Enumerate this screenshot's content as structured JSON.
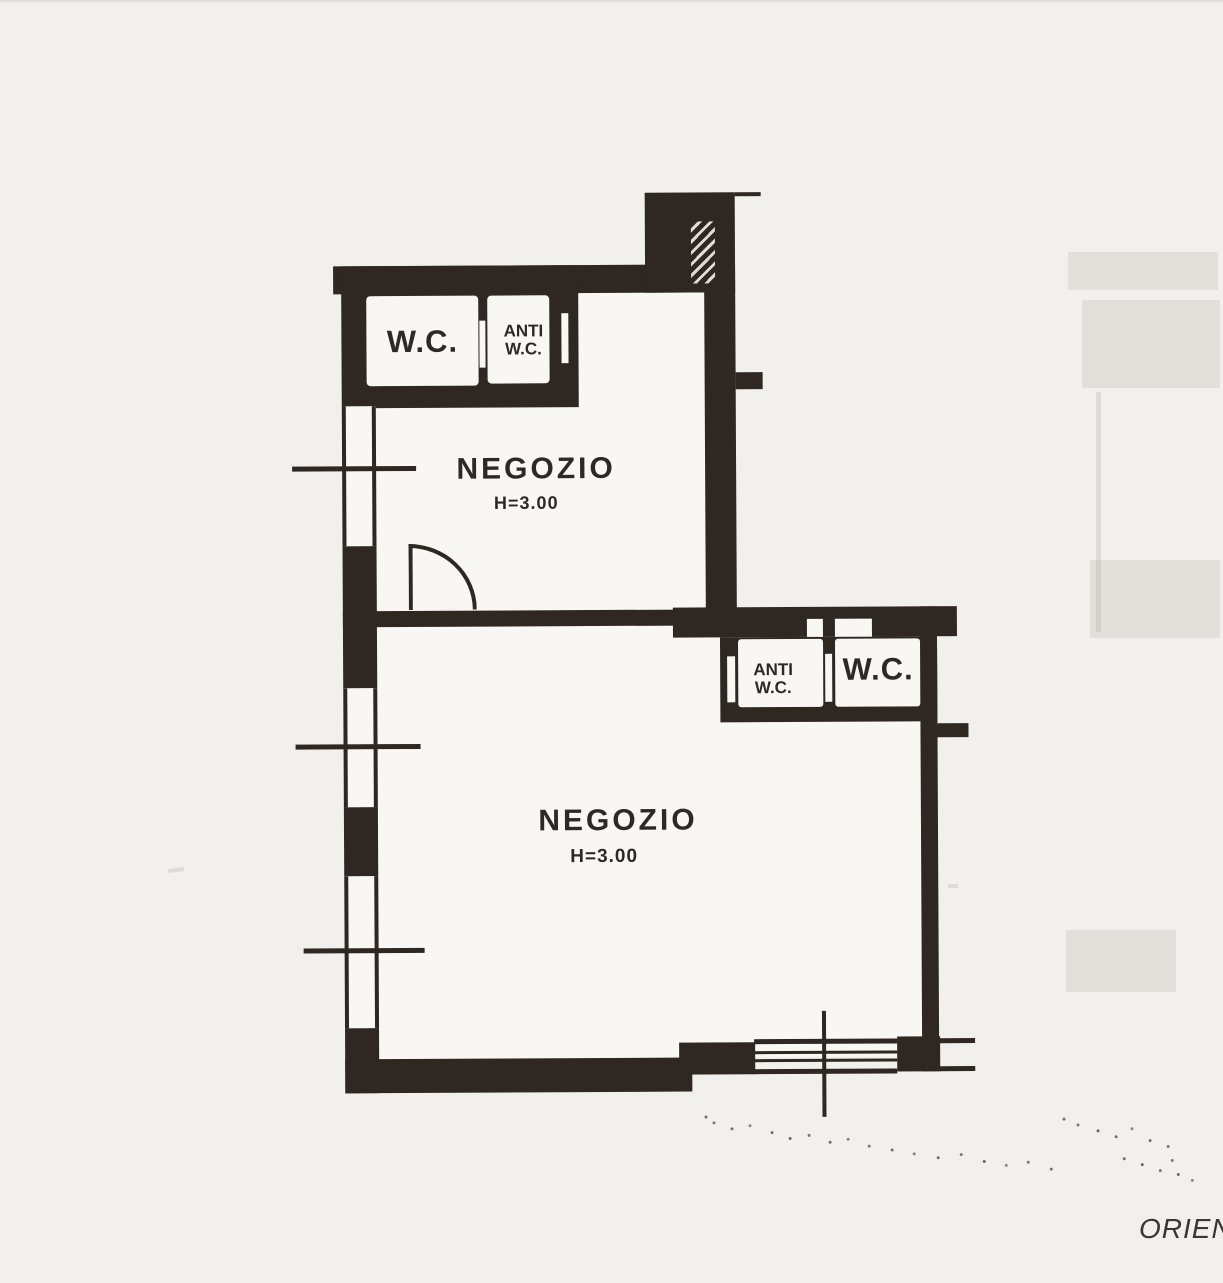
{
  "colors": {
    "paper": "#f1f0ec",
    "ink": "#2f2721",
    "room": "#f8f7f3",
    "text": "#2b2a28"
  },
  "plan": {
    "upper_unit": {
      "wc_label": "W.C.",
      "antiwc_line1": "ANTI",
      "antiwc_line2": "W.C.",
      "room_label": "NEGOZIO",
      "room_height": "H=3.00"
    },
    "lower_unit": {
      "antiwc_line1": "ANTI",
      "antiwc_line2": "W.C.",
      "wc_label": "W.C.",
      "room_label": "NEGOZIO",
      "room_height": "H=3.00"
    },
    "corner_annotation": "ORIENT"
  }
}
